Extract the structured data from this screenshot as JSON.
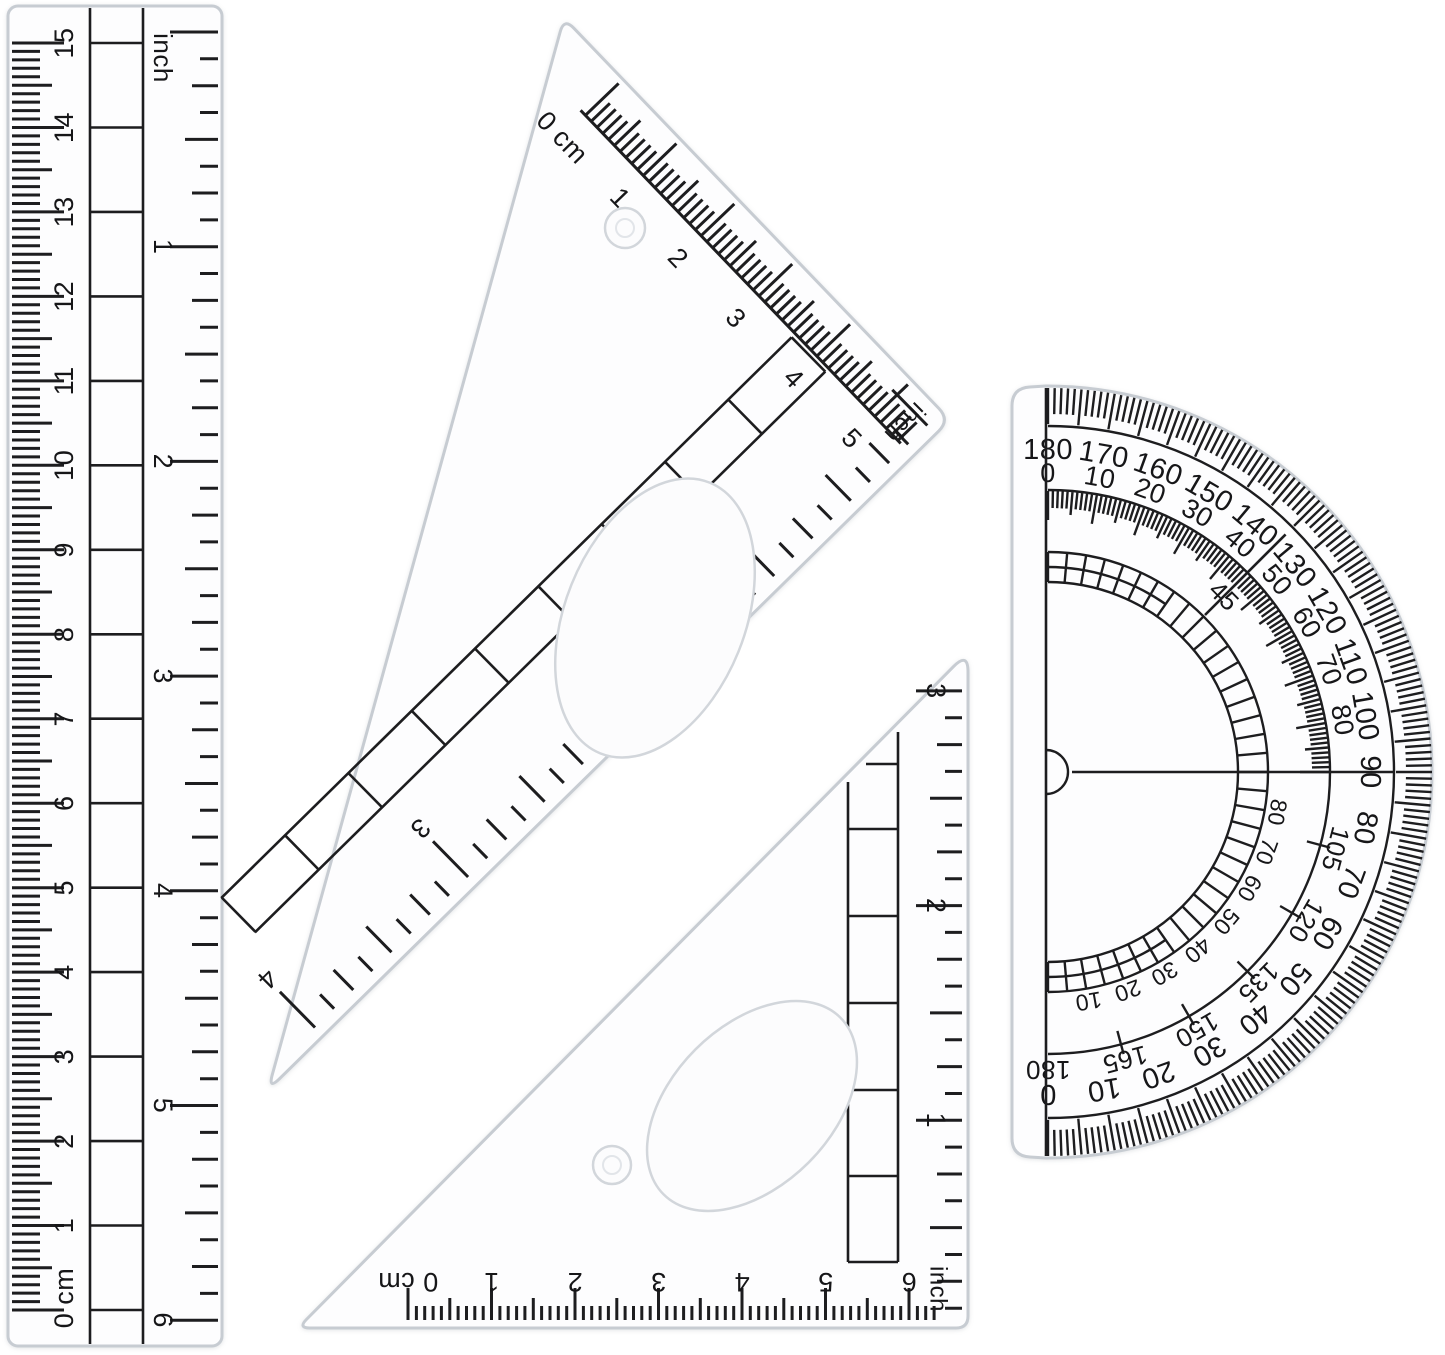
{
  "scene": {
    "description": "transparent plastic geometry set on white: ruler, two set squares, protractor",
    "colors": {
      "background": "#ffffff",
      "ink": "#1d1d1f",
      "plastic_edge": "#c7ccd2",
      "plastic_fill": "#fdfdfe"
    }
  },
  "ruler": {
    "cm_labels": [
      "0 cm",
      "1",
      "2",
      "3",
      "4",
      "5",
      "6",
      "7",
      "8",
      "9",
      "10",
      "11",
      "12",
      "13",
      "14",
      "15"
    ],
    "inch_title": "inch",
    "inch_labels": [
      "1",
      "2",
      "3",
      "4",
      "5",
      "6"
    ]
  },
  "triangle_top": {
    "cm_labels": [
      "0 cm",
      "1",
      "2",
      "3",
      "4",
      "5"
    ],
    "inch_title": "inch",
    "inch_labels": [
      "1",
      "2",
      "3",
      "4"
    ]
  },
  "triangle_bottom": {
    "cm_labels": [
      "0 cm",
      "1",
      "2",
      "3",
      "4",
      "5",
      "6"
    ],
    "inch_title": "inch",
    "inch_labels": [
      "1",
      "2",
      "3"
    ]
  },
  "protractor": {
    "outer_labels": [
      "180",
      "170",
      "160",
      "150",
      "140",
      "130",
      "120",
      "110",
      "100",
      "90",
      "80",
      "70",
      "60",
      "50",
      "40",
      "30",
      "20",
      "10",
      "0"
    ],
    "inner_upper_labels": [
      "0",
      "10",
      "20",
      "30",
      "40",
      "50",
      "60",
      "70",
      "80"
    ],
    "inner_lower_labels": [
      "105",
      "120",
      "135",
      "150",
      "165",
      "180"
    ],
    "ladder_labels": [
      "10",
      "20",
      "30",
      "40",
      "50",
      "60",
      "70",
      "80"
    ],
    "ladder_mid_label": "45"
  }
}
